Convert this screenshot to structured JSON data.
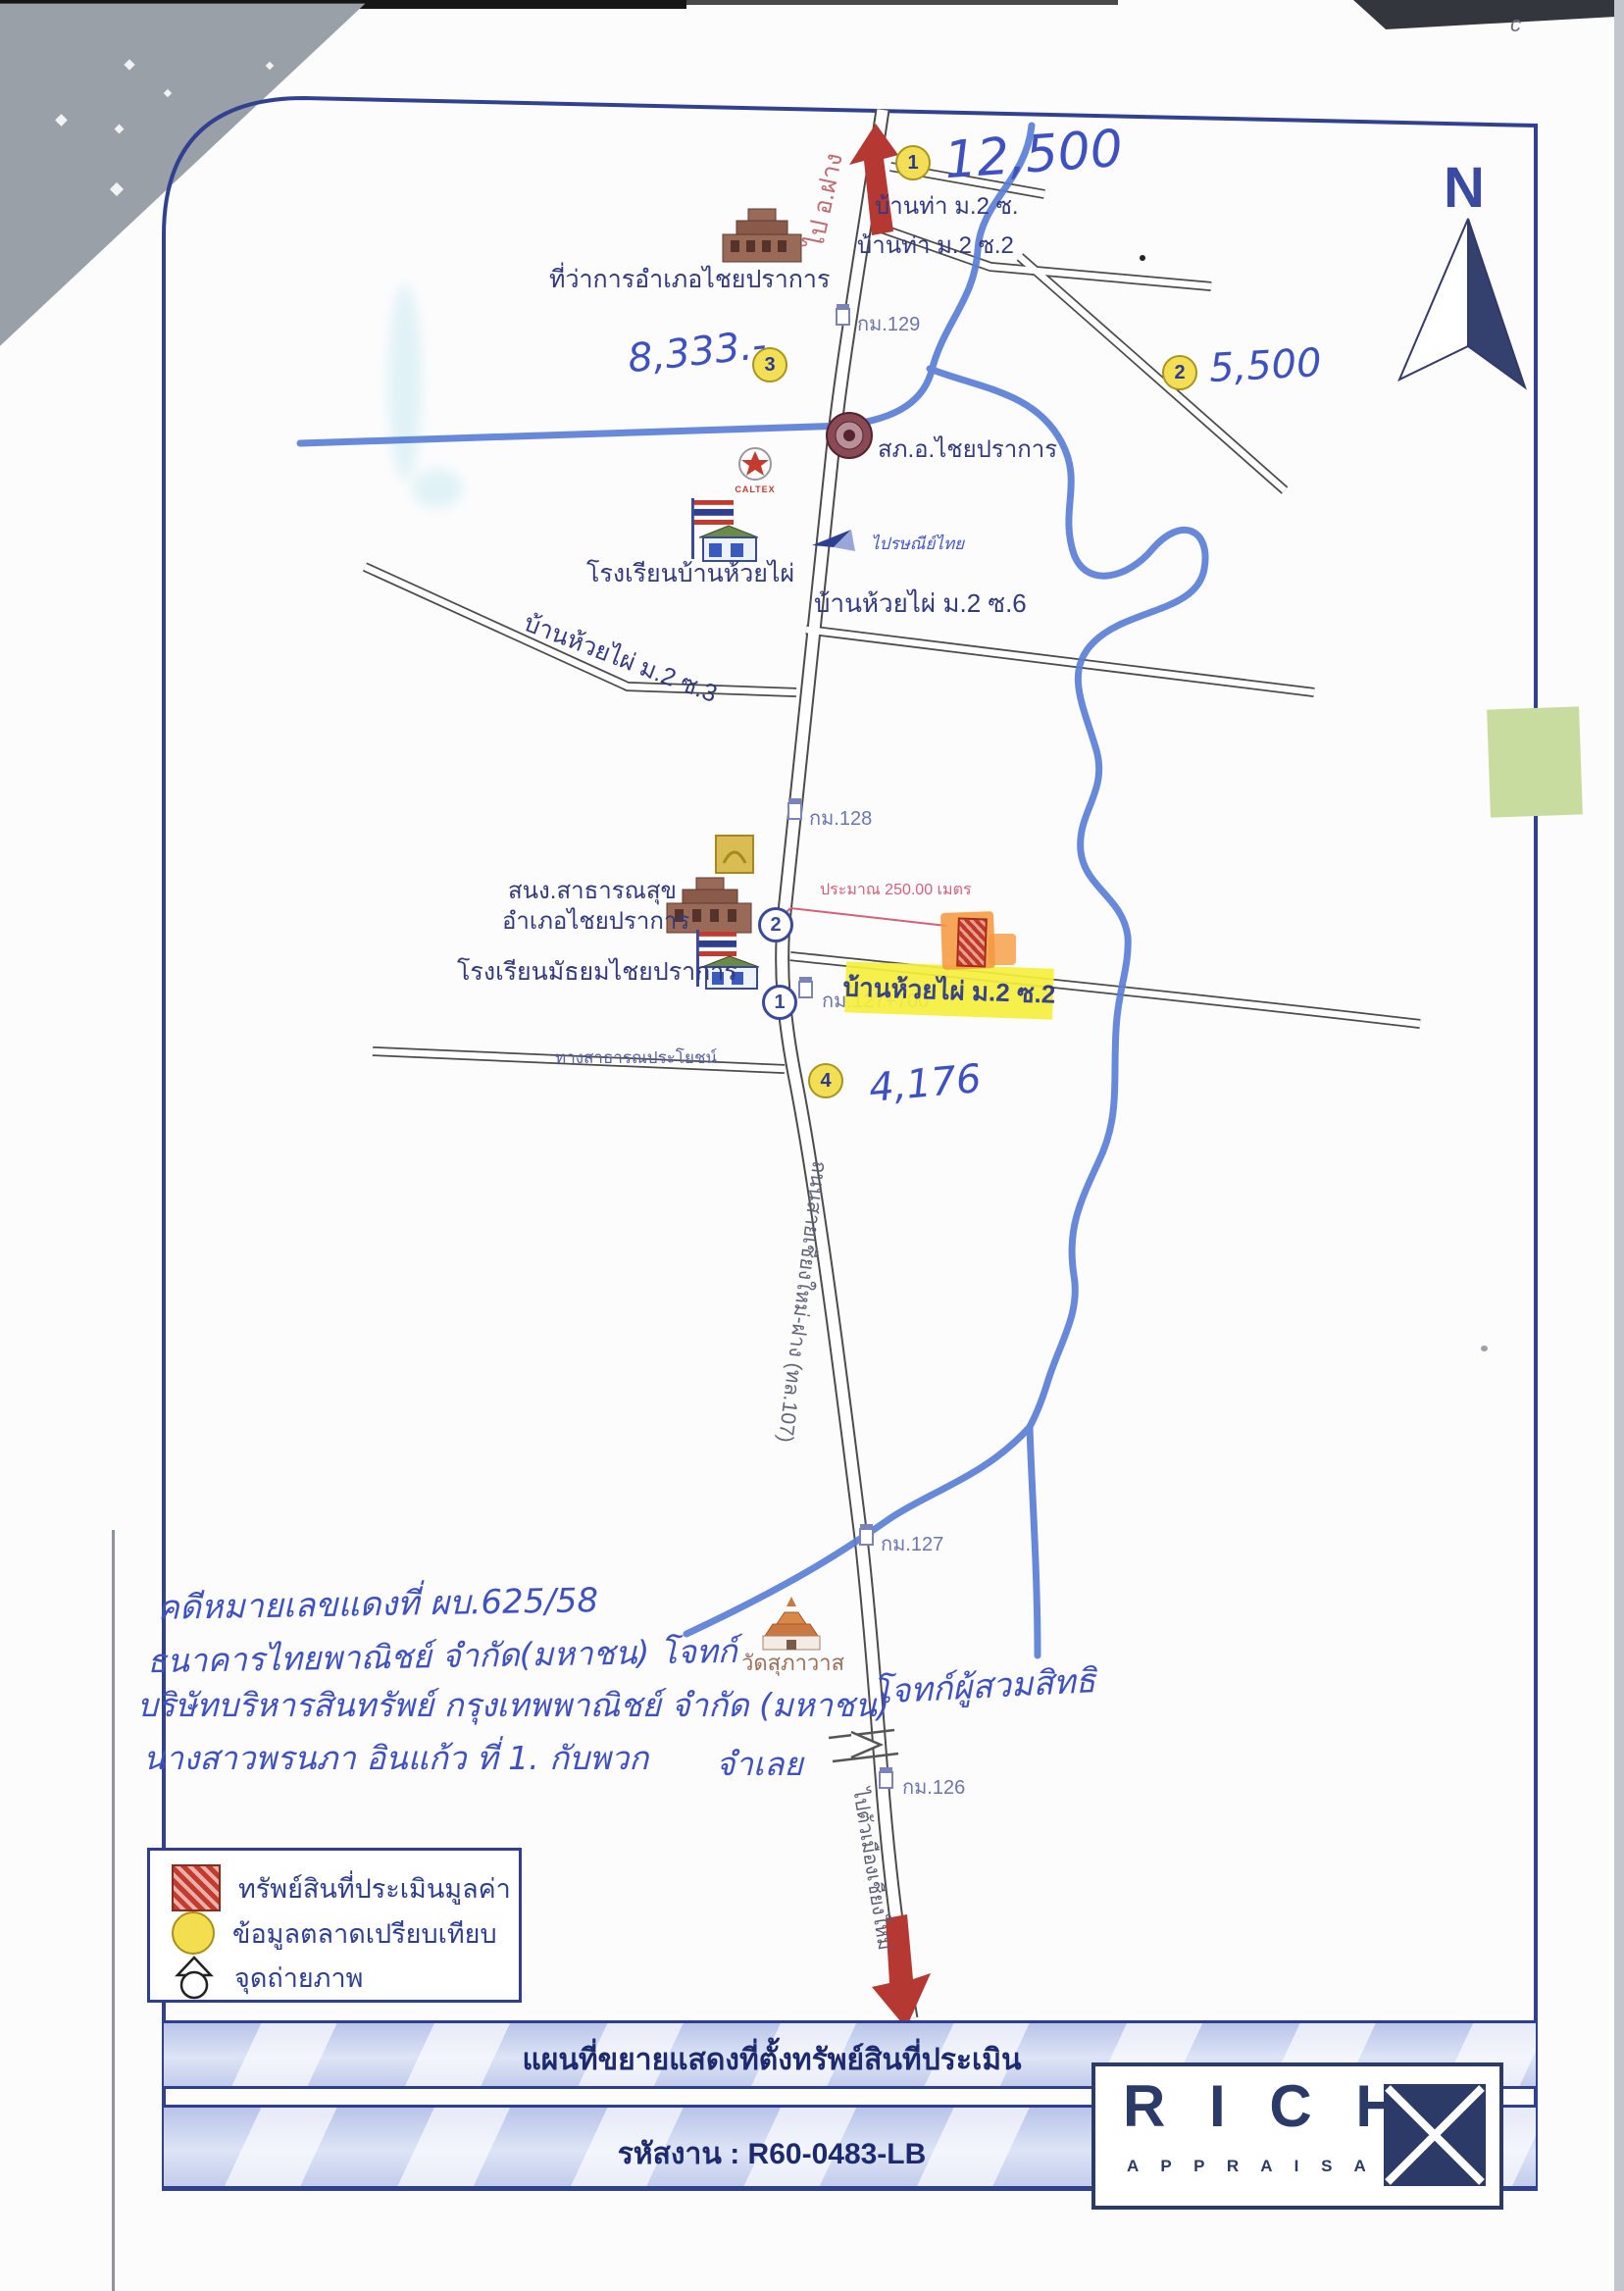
{
  "compass": {
    "label": "N"
  },
  "roads": {
    "highway": "ถนนสายเชียงใหม่-ฝาง (ทล.107)",
    "to_fang": "ไป อ.ฝาง",
    "to_chiangmai": "ไปตัวเมืองเชียงใหม่",
    "public_road": "ทางสาธารณประโยชน์",
    "bantha_soi1": "บ้านท่า ม.2 ซ.",
    "bantha_soi2": "บ้านท่า ม.2 ซ.2",
    "huaiphai_soi6": "บ้านห้วยไผ่ ม.2 ซ.6",
    "huaiphai_soi3": "บ้านห้วยไผ่ ม.2 ซ.3",
    "huaiphai_soi2": "บ้านห้วยไผ่ ม.2 ซ.2"
  },
  "places": {
    "district_office": "ที่ว่าการอำเภอไชยปราการ",
    "police_station": "สภ.อ.ไชยปราการ",
    "caltex": "CALTEX",
    "school_banhuaiphai": "โรงเรียนบ้านห้วยไผ่",
    "thailand_post": "ไปรษณีย์ไทย",
    "health_office_line1": "สนง.สาธารณสุข",
    "health_office_line2": "อำเภอไชยปราการ",
    "school_mathayom": "โรงเรียนมัธยมไชยปราการ",
    "temple": "วัดสุภาวาส"
  },
  "km_signs": {
    "km129": "กม.129",
    "km128": "กม.128",
    "km127_700": "กม.127+700",
    "km127": "กม.127",
    "km126": "กม.126"
  },
  "property": {
    "distance_note": "ประมาณ 250.00 เมตร"
  },
  "markers": {
    "m1": {
      "no": "1",
      "value": "12,500"
    },
    "m2": {
      "no": "2",
      "value": "5,500"
    },
    "m3": {
      "no": "3",
      "value": "8,333.-"
    },
    "m4": {
      "no": "4",
      "value": "4,176"
    }
  },
  "photo_points": {
    "p1": "1",
    "p2": "2"
  },
  "handwriting": {
    "line1": "คดีหมายเลขแดงที่ ผบ.625/58",
    "line2": "ธนาคารไทยพาณิชย์ จำกัด(มหาชน) โจทก์",
    "line3": "บริษัทบริหารสินทรัพย์ กรุงเทพพาณิชย์ จำกัด (มหาชน)",
    "line3b": "โจทก์ผู้สวมสิทธิ",
    "line4": "นางสาวพรนภา อินแก้ว ที่ 1. กับพวก",
    "line5": "จำเลย"
  },
  "legend": {
    "property_label": "ทรัพย์สินที่ประเมินมูลค่า",
    "market_label": "ข้อมูลตลาดเปรียบเทียบ",
    "photo_label": "จุดถ่ายภาพ"
  },
  "footer": {
    "title": "แผนที่ขยายแสดงที่ตั้งทรัพย์สินที่ประเมิน",
    "job_code": "รหัสงาน : R60-0483-LB"
  },
  "logo": {
    "word": "R I C H",
    "subtitle": "A P P R A I S A L"
  }
}
